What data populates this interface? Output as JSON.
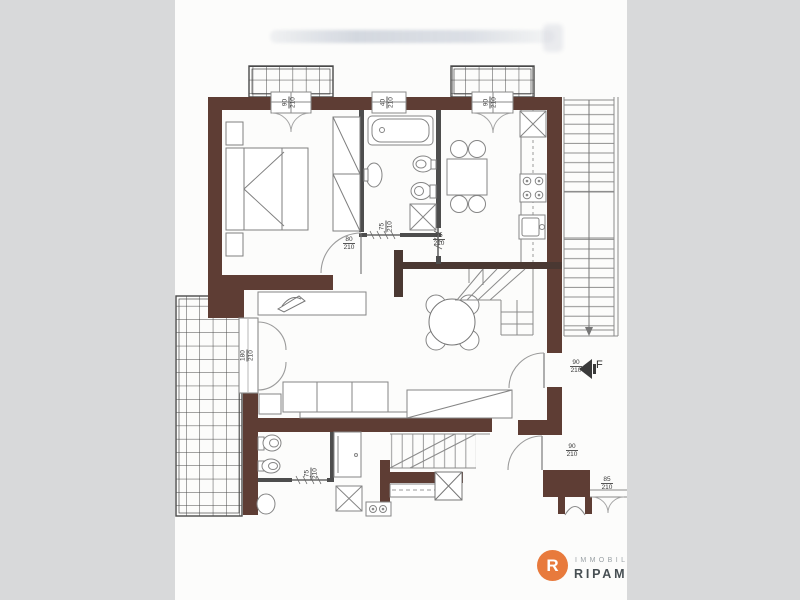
{
  "colors": {
    "background_band": "#d8d9da",
    "paper": "#fcfcfb",
    "wall": "#5e3d34",
    "accent_orange": "#e87a3c"
  },
  "plan": {
    "entrance_marker": "F",
    "dim_labels": [
      {
        "w": "90",
        "h": "210"
      },
      {
        "w": "40",
        "h": "210"
      },
      {
        "w": "90",
        "h": "210"
      },
      {
        "w": "75",
        "h": "210"
      },
      {
        "w": "80",
        "h": "210"
      },
      {
        "w": "75",
        "h": "210"
      },
      {
        "w": "180",
        "h": "210"
      },
      {
        "w": "90",
        "h": "210"
      },
      {
        "w": "90",
        "h": "210"
      },
      {
        "w": "75",
        "h": "210"
      },
      {
        "w": "85",
        "h": "210"
      }
    ]
  },
  "logo": {
    "icon_letter": "R",
    "line1": "IMMOBILI",
    "line2": "RIPAMO"
  }
}
